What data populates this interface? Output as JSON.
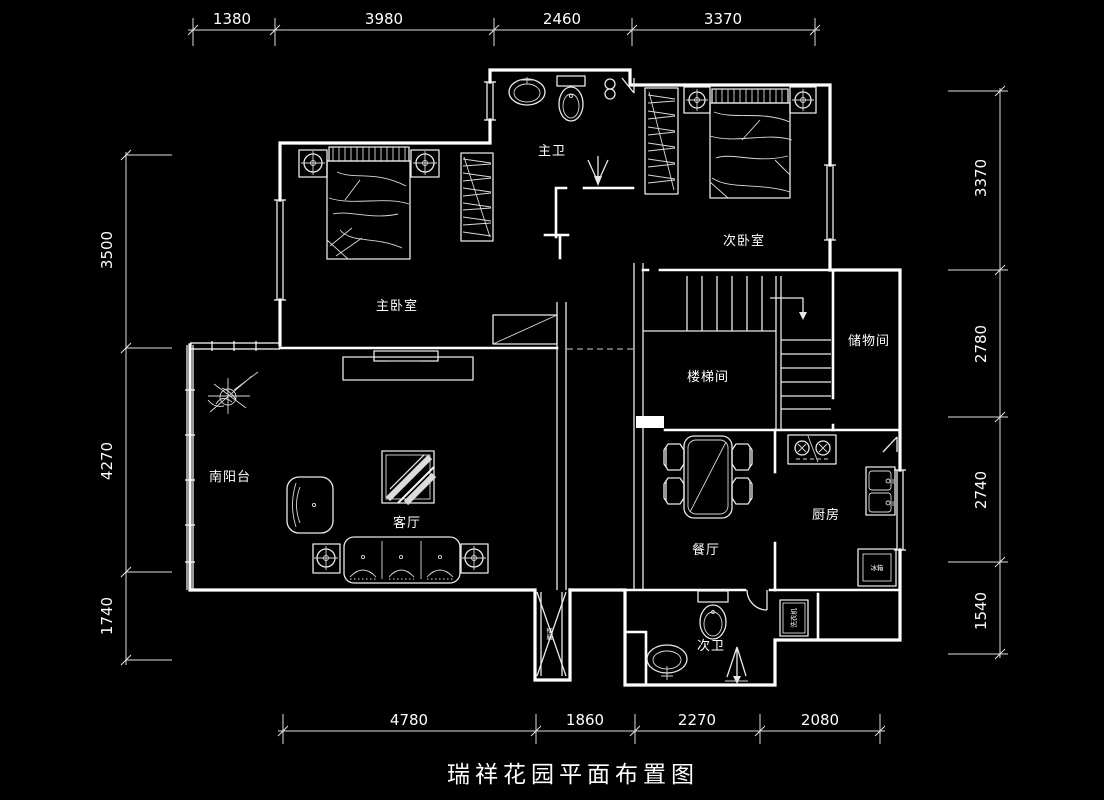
{
  "title": "瑞祥花园平面布置图",
  "colors": {
    "background": "#000000",
    "line": "#ffffff"
  },
  "dimensions": {
    "top": [
      "1380",
      "3980",
      "2460",
      "3370"
    ],
    "bottom": [
      "4780",
      "1860",
      "2270",
      "2080"
    ],
    "left": [
      "3500",
      "4270",
      "1740"
    ],
    "right": [
      "3370",
      "2780",
      "2740",
      "1540"
    ]
  },
  "rooms": {
    "master_bath": "主卫",
    "second_bedroom": "次卧室",
    "master_bedroom": "主卧室",
    "stairwell": "楼梯间",
    "storage": "储物间",
    "south_balcony": "南阳台",
    "living_room": "客厅",
    "dining_room": "餐厅",
    "kitchen": "厨房",
    "second_bath": "次卫"
  },
  "fixtures": {
    "washing_machine": "洗衣机",
    "fridge": "冰箱",
    "flue": "烟道"
  }
}
